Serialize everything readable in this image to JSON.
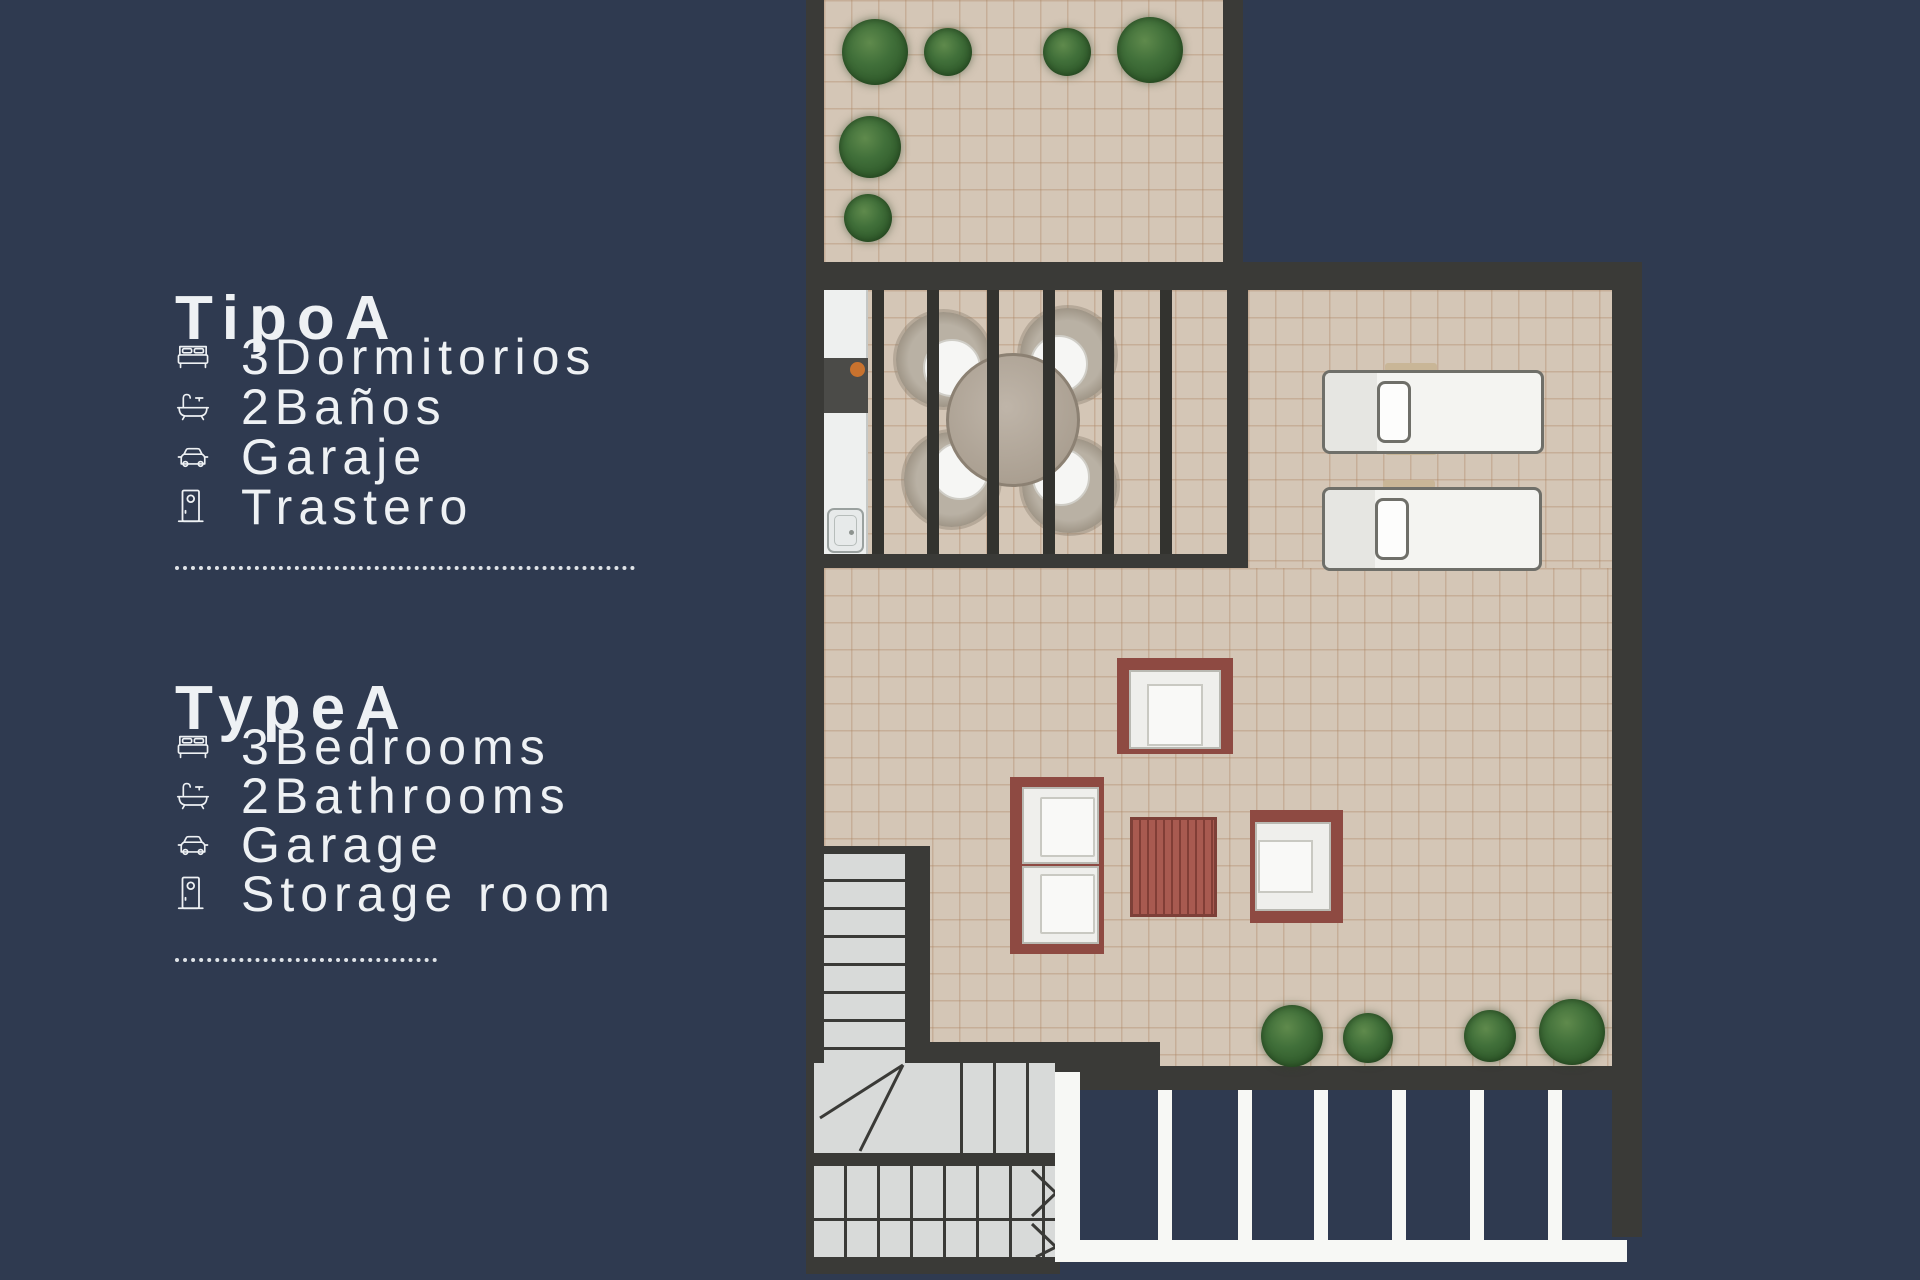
{
  "colors": {
    "background": "#2f3a50",
    "plan_wall": "#3a3a37",
    "tile": "#d4c6b6",
    "stair": "#d8dad9",
    "furniture_red": "#8e4a42",
    "table_red": "#a85a50",
    "lounger_white": "#f4f4f1",
    "pergola_white": "#f7f8f5",
    "plant_green": "#41703a",
    "counter_dark": "#4b4b48",
    "burner_orange": "#c8722e",
    "text": "#eef1f4"
  },
  "legend_es": {
    "title": "TipoA",
    "items": [
      {
        "icon": "bed-icon",
        "label": "3Dormitorios"
      },
      {
        "icon": "bath-icon",
        "label": "2Baños"
      },
      {
        "icon": "car-icon",
        "label": "Garaje"
      },
      {
        "icon": "door-icon",
        "label": "Trastero"
      }
    ]
  },
  "legend_en": {
    "title": "TypeA",
    "items": [
      {
        "icon": "bed-icon",
        "label": "3Bedrooms"
      },
      {
        "icon": "bath-icon",
        "label": "2Bathrooms"
      },
      {
        "icon": "car-icon",
        "label": "Garage"
      },
      {
        "icon": "door-icon",
        "label": "Storage room"
      }
    ]
  },
  "floorplan": {
    "visible_elements": [
      "roof-terrace",
      "kitchenette",
      "pergola-dining",
      "sun-loungers",
      "lounge-sofa",
      "armchairs",
      "coffee-table",
      "staircase",
      "planter-bushes",
      "trellis"
    ]
  }
}
